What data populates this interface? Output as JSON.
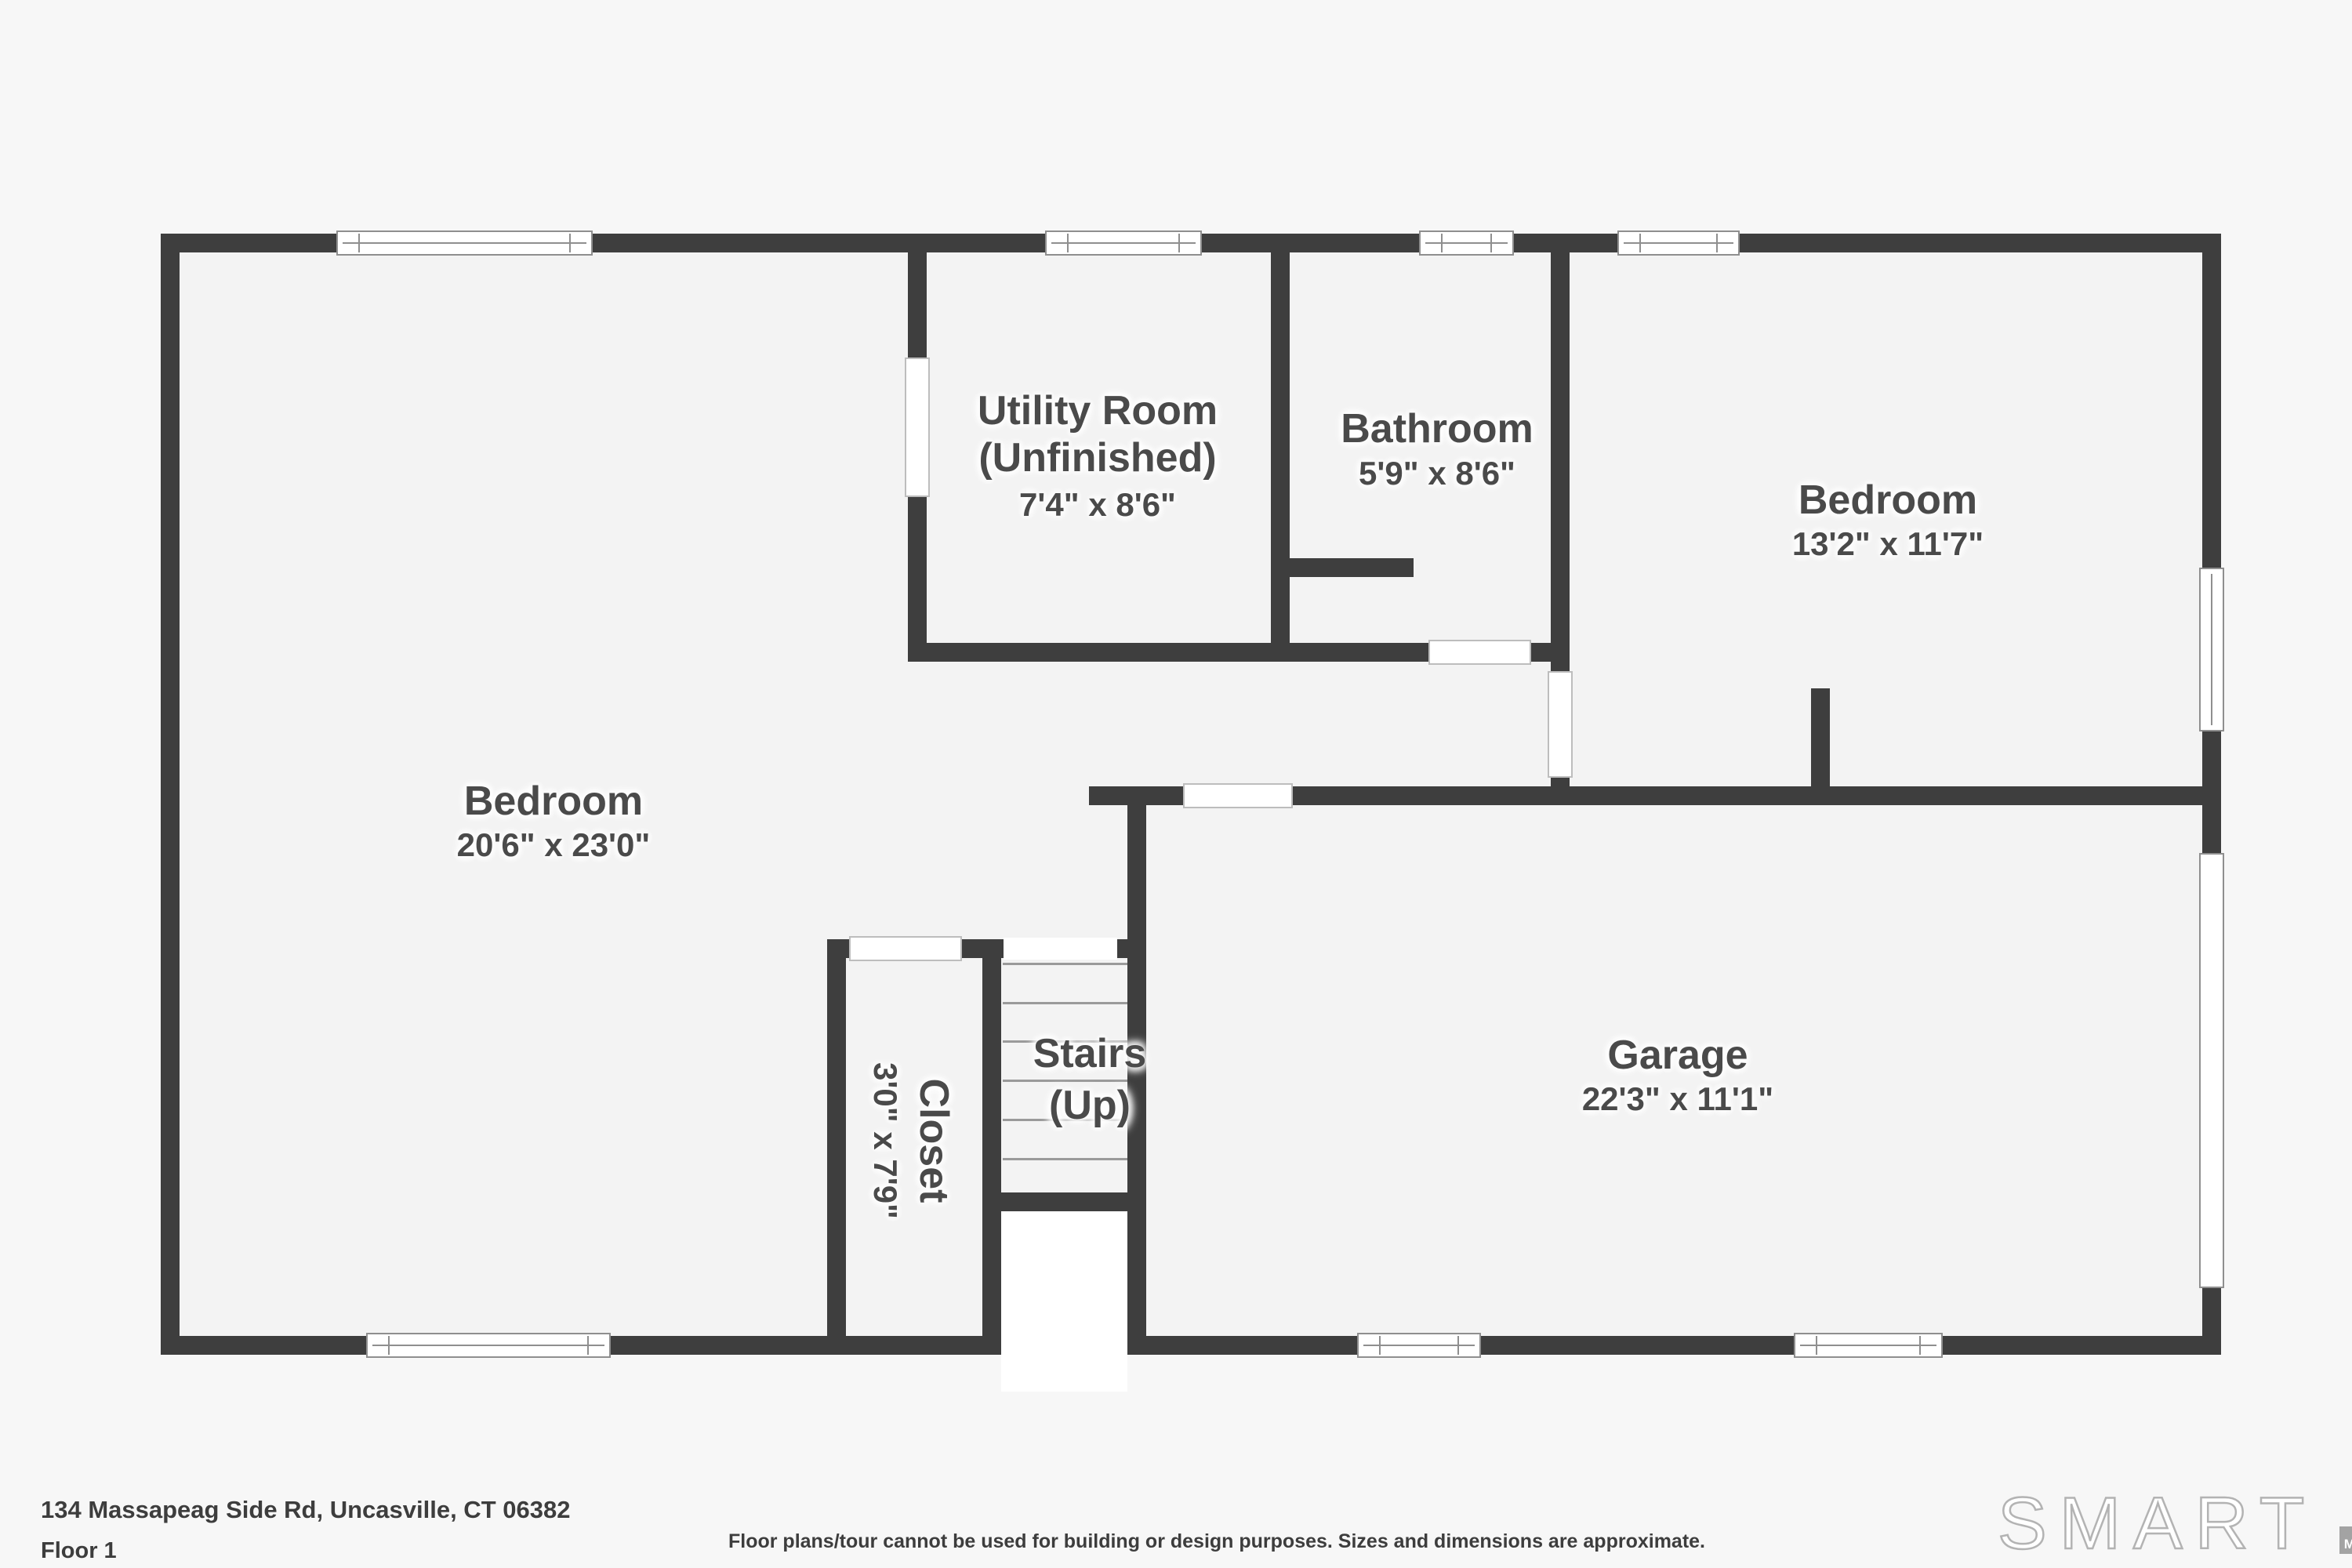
{
  "colors": {
    "wall": "#3e3e3e",
    "room_fill": "#f3f3f3",
    "page_bg": "#f7f7f7",
    "text": "#4a4a4a",
    "logo_bar_m": "#a3a3a3",
    "logo_bar_l": "#686868",
    "logo_bar_s": "#3a3a3a",
    "logo_outline": "#b3b3b3"
  },
  "rooms": {
    "utility": {
      "name": "Utility Room",
      "qualifier": "(Unfinished)",
      "dims": "7'4\" x 8'6\""
    },
    "bathroom": {
      "name": "Bathroom",
      "dims": "5'9\" x 8'6\""
    },
    "bedroom_right": {
      "name": "Bedroom",
      "dims": "13'2\" x 11'7\""
    },
    "bedroom_left": {
      "name": "Bedroom",
      "dims": "20'6\" x 23'0\""
    },
    "garage": {
      "name": "Garage",
      "dims": "22'3\" x 11'1\""
    },
    "stairs": {
      "name": "Stairs",
      "qualifier": "(Up)"
    },
    "closet": {
      "name": "Closet",
      "dims": "3'0\" x 7'9\""
    }
  },
  "footer": {
    "address": "134 Massapeag Side Rd, Uncasville, CT 06382",
    "floor": "Floor 1",
    "disclaimer": "Floor plans/tour cannot be used for building or design purposes. Sizes and dimensions are approximate."
  },
  "logo": {
    "brand": "SMART",
    "bars": [
      {
        "letter": "M"
      },
      {
        "letter": "L"
      },
      {
        "letter": "S"
      }
    ]
  }
}
